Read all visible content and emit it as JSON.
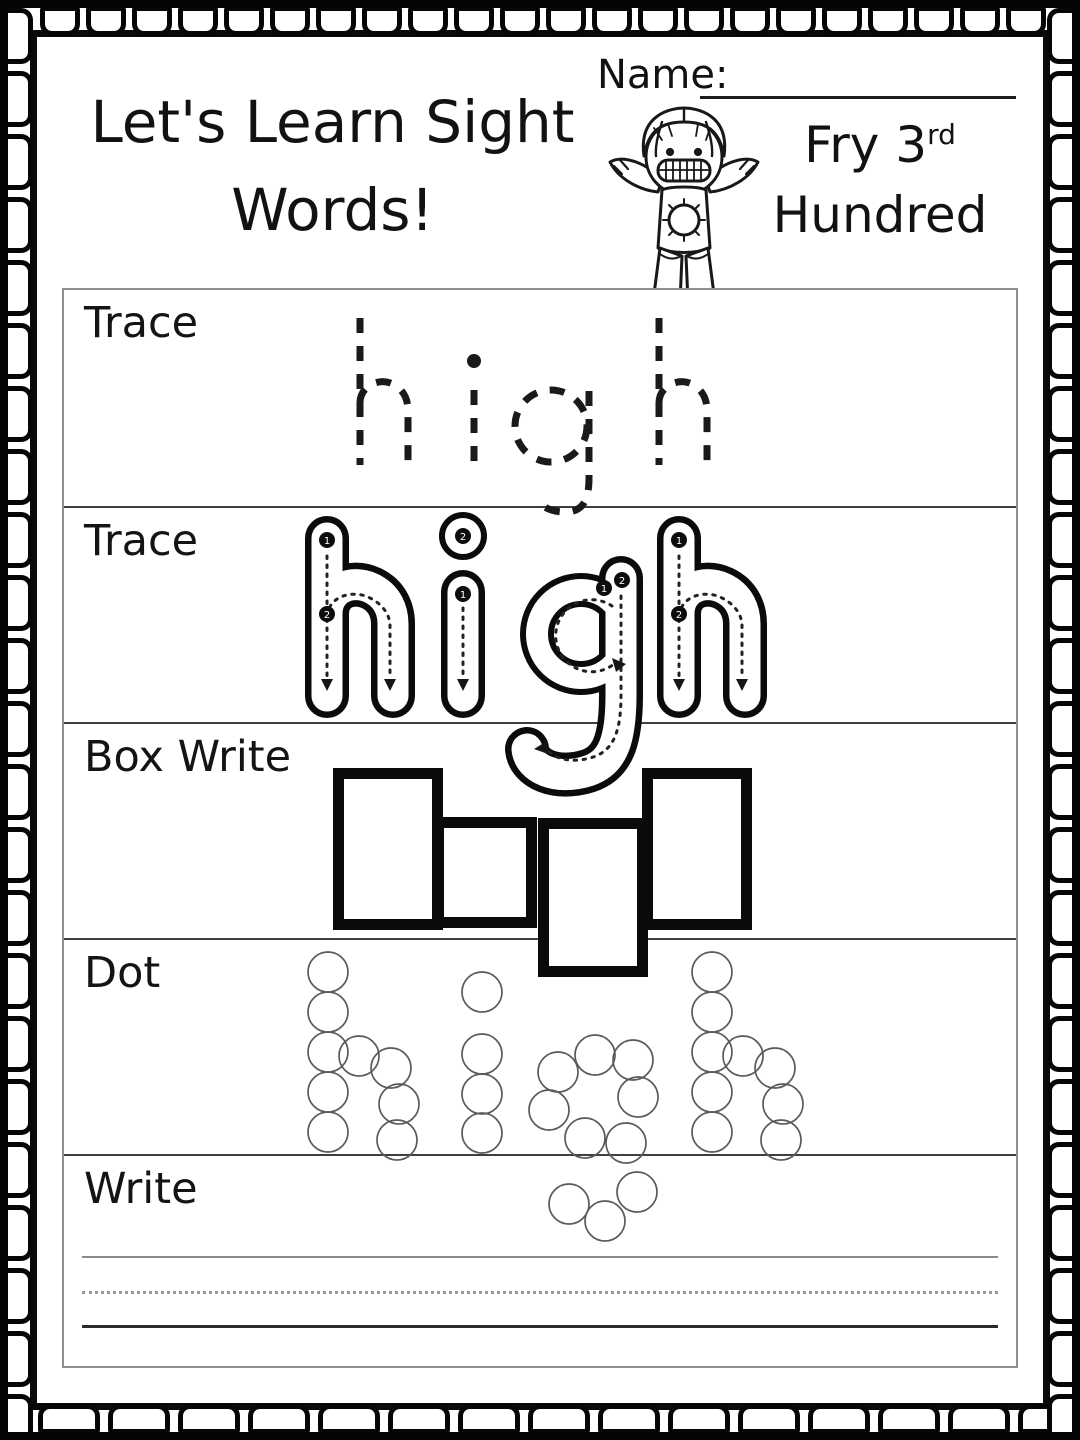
{
  "page": {
    "background": "#ffffff",
    "ink": "#111111",
    "table_border_color": "#8f8f8f",
    "row_line_color": "#3f3f3f"
  },
  "header": {
    "title_line1": "Let's Learn Sight",
    "title_line2": "Words!",
    "name_label": "Name:",
    "name_value": "",
    "series_line1_prefix": "Fry 3",
    "series_line1_ordinal": "rd",
    "series_line2": "Hundred"
  },
  "worksheet": {
    "word": "high",
    "rows": [
      {
        "label": "Trace",
        "style": "dashed-letters"
      },
      {
        "label": "Trace",
        "style": "outline-letters-with-guides"
      },
      {
        "label": "Box Write",
        "style": "letter-shape-boxes"
      },
      {
        "label": "Dot",
        "style": "dot-circle-letters"
      },
      {
        "label": "Write",
        "style": "handwriting-lines"
      }
    ],
    "trace_start_numbers": [
      "1",
      "2"
    ],
    "letter_box_shapes": [
      "tall",
      "short",
      "descender",
      "tall"
    ]
  },
  "icons": {
    "girl": "smiling-girl-clipart"
  }
}
